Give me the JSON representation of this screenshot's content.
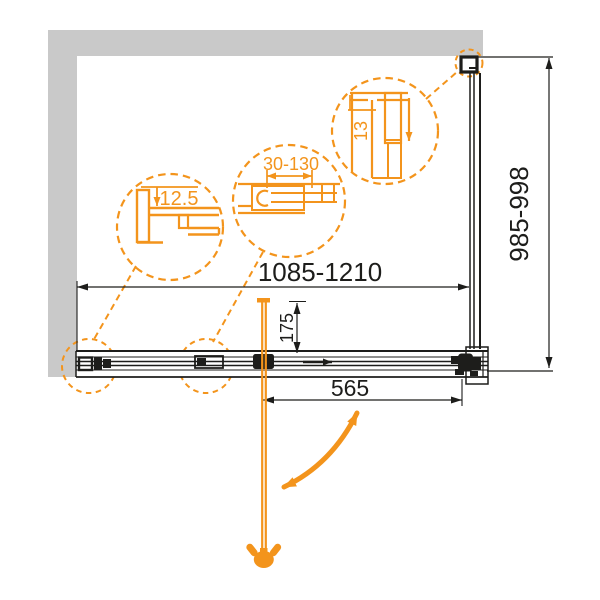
{
  "diagram": {
    "title": "Sliding shower door installation drawing (plan view)",
    "colors": {
      "accent_orange": "#F3941C",
      "wall_gray": "#C9C9C9",
      "line_black": "#1D1D1B",
      "background": "#FFFFFF"
    },
    "dimensions": {
      "width_range": "1085-1210",
      "height_range": "985-998",
      "handle_offset": "175",
      "door_width": "565"
    },
    "details": {
      "wall_profile": {
        "label": "12.5"
      },
      "adjustment": {
        "label": "30-130"
      },
      "top_profile": {
        "label": "13"
      }
    },
    "icons": {
      "swing": "double-curved-arrow",
      "slide": "right-arrow",
      "drop": "down-arrow"
    }
  }
}
